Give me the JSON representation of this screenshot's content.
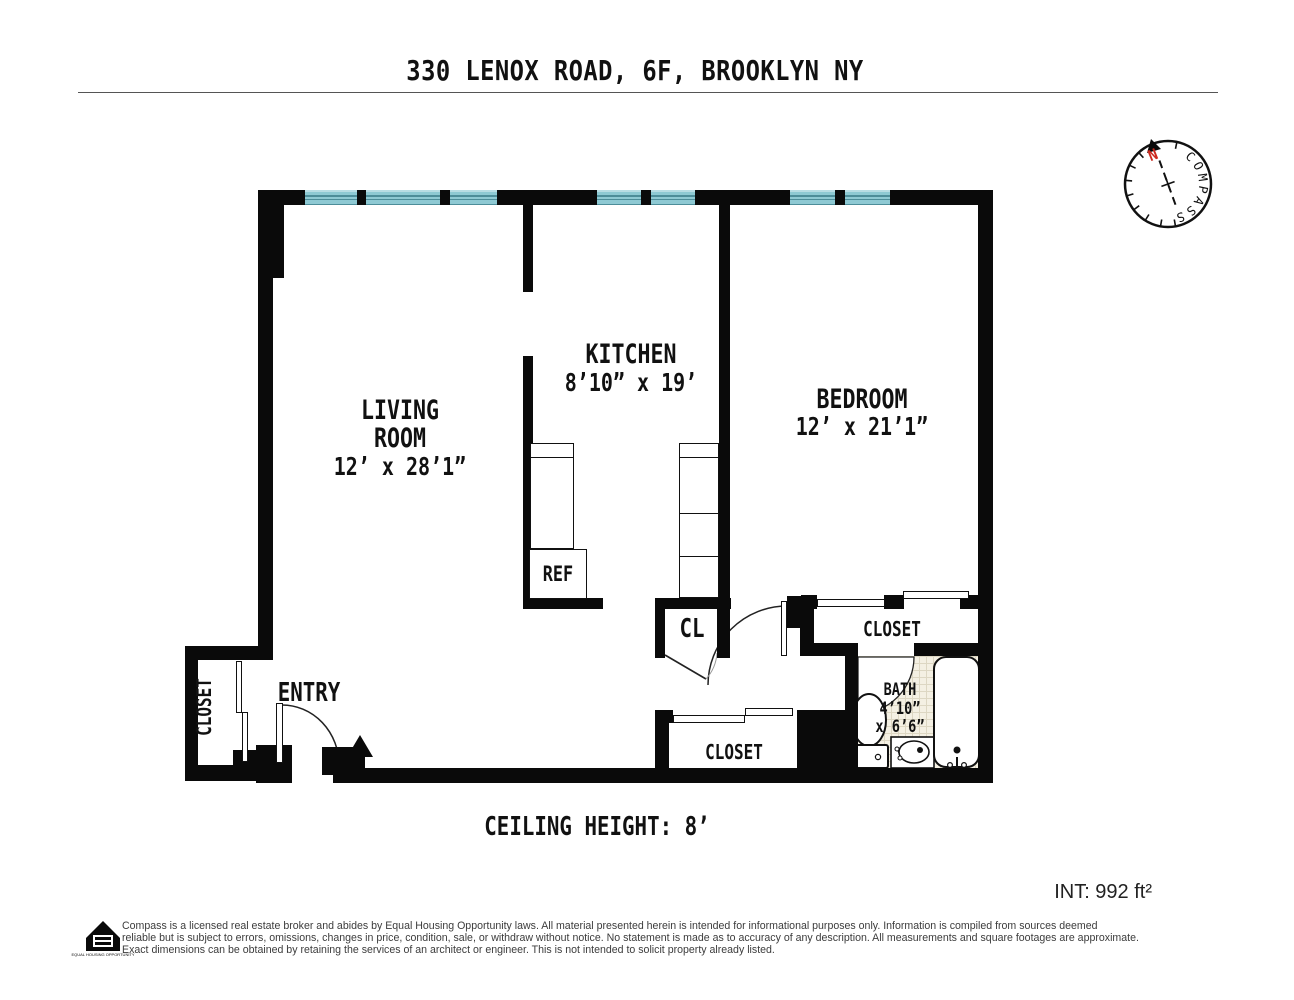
{
  "title": "330 LENOX ROAD, 6F, BROOKLYN NY",
  "compass": {
    "ring_text": "COMPASS",
    "north": "N"
  },
  "labels": {
    "living_room": {
      "line1": "LIVING",
      "line2": "ROOM",
      "dims": "12’ x 28’1”"
    },
    "kitchen": {
      "name": "KITCHEN",
      "dims": "8’10” x 19’"
    },
    "bedroom": {
      "name": "BEDROOM",
      "dims": "12’ x 21’1”"
    },
    "bath": {
      "name": "BATH",
      "dim1": "4’10”",
      "dim2": "x 6’6”"
    },
    "entry": "ENTRY",
    "ref": "REF",
    "cl": "CL",
    "closet_entry": "CLOSET",
    "closet_bedroom": "CLOSET",
    "closet_hall": "CLOSET"
  },
  "footer": {
    "ceiling_height": "CEILING HEIGHT: 8’",
    "interior_area": "INT: 992 ft²",
    "equal_housing_label": "EQUAL HOUSING OPPORTUNITY",
    "disclaimer_lines": [
      "Compass is a licensed real estate broker and abides by Equal Housing Opportunity laws. All material presented herein is intended for informational purposes only. Information is compiled from sources deemed",
      "reliable but is subject to errors, omissions, changes in price, condition, sale, or withdraw without notice. No statement is made as to accuracy of any description. All measurements and square footages are approximate.",
      "Exact dimensions can be obtained by retaining the services of an architect or engineer. This is not intended to solicit property already listed."
    ]
  },
  "colors": {
    "wall": "#0a0a0a",
    "window": "#8ec9d3",
    "window_line": "#4d8d99",
    "tile_bg": "#f4f0e3",
    "tile_line": "#ddd7c3",
    "north_red": "#cc2a1e"
  }
}
